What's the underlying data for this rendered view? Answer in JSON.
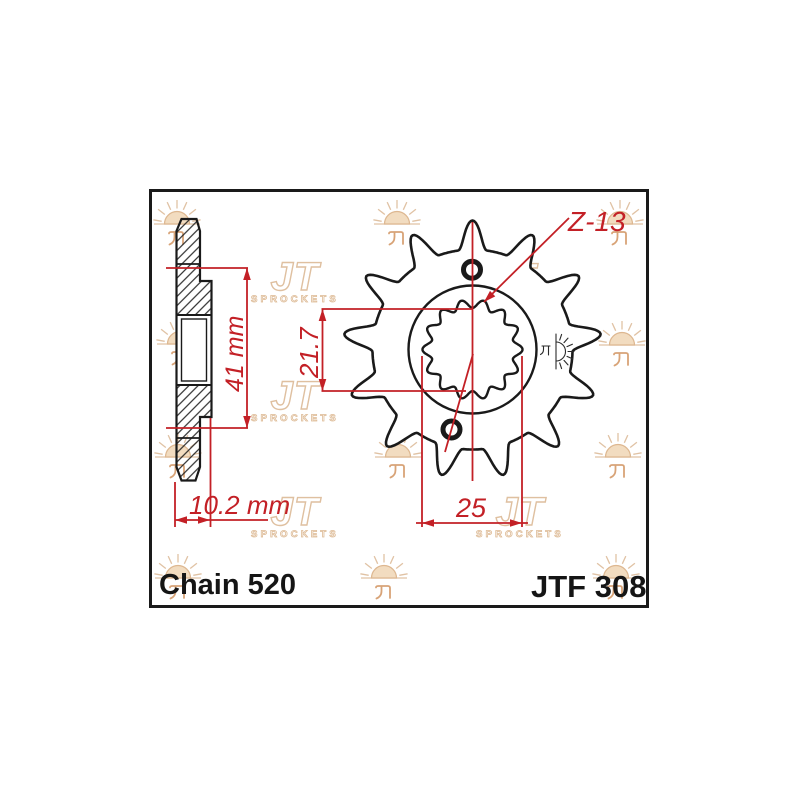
{
  "title": {
    "chain": "Chain 520",
    "part": "JTF 308"
  },
  "dimensions": {
    "overall_width": "41 mm",
    "hub_width": "10.2 mm",
    "bore_diameter": "21.7",
    "spline_diameter": "25",
    "teeth_count": "Z-13"
  },
  "watermark": {
    "jt": "JT",
    "sprockets": "SPROCKETS"
  },
  "colors": {
    "dimension_red": "#c32026",
    "line_black": "#1a1a1a",
    "watermark_tan": "#e0c2a4"
  }
}
